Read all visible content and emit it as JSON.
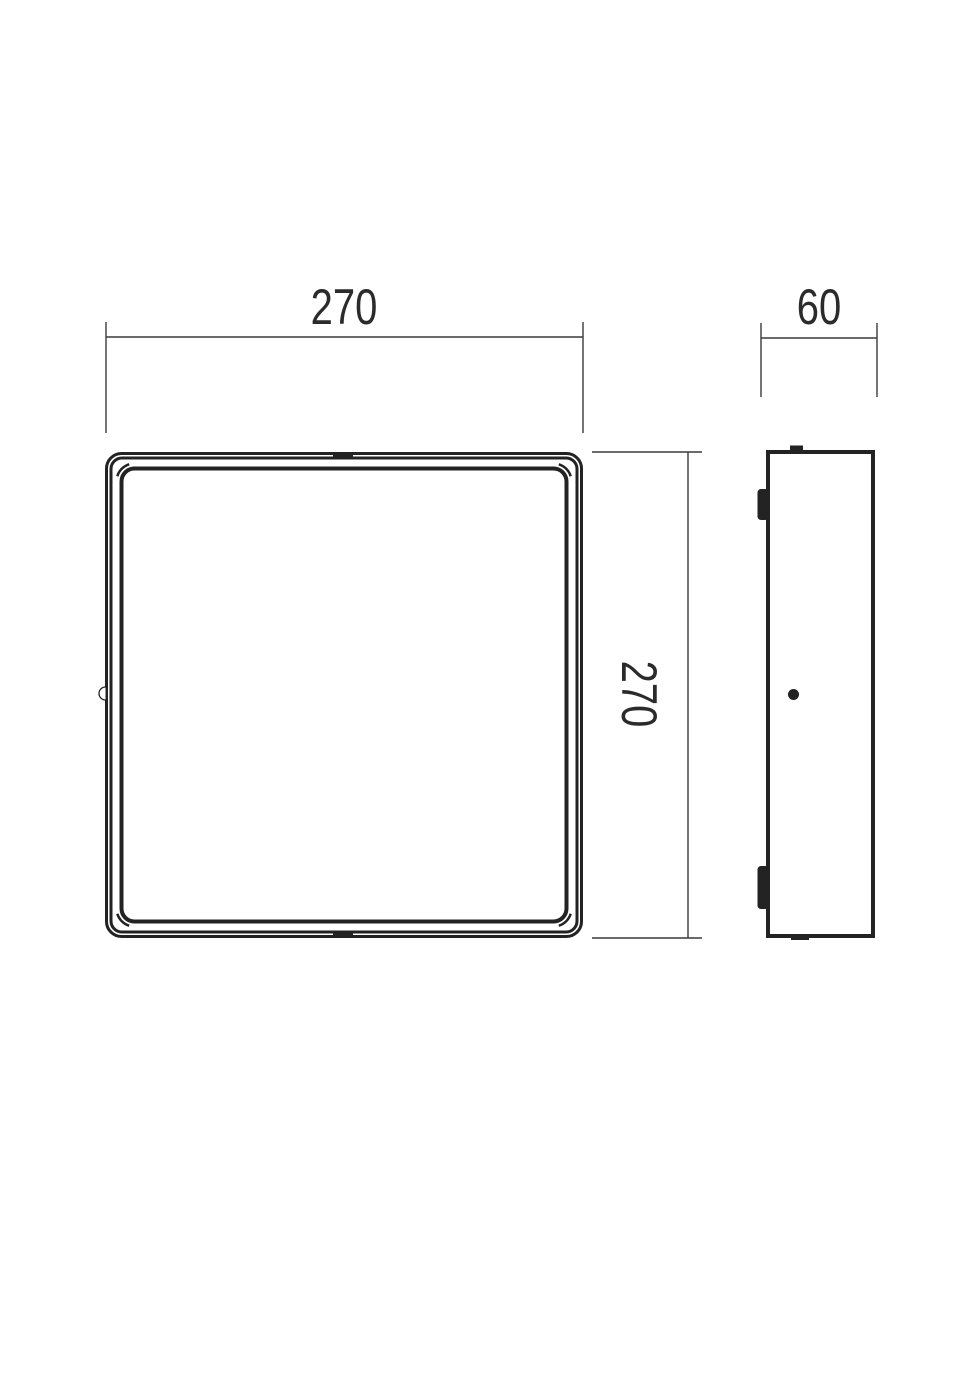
{
  "drawing": {
    "kind": "dimensioned-technical-drawing",
    "views": {
      "front": {
        "width_label": "270",
        "height_label": "270"
      },
      "side": {
        "depth_label": "60"
      }
    }
  },
  "dimensions": {
    "width": {
      "value": "270"
    },
    "height": {
      "value": "270"
    },
    "depth": {
      "value": "60"
    }
  },
  "colors": {
    "outline": "#232323",
    "dimension_line": "#3a3a3a",
    "text": "#2b2b2b",
    "background": "#ffffff"
  }
}
